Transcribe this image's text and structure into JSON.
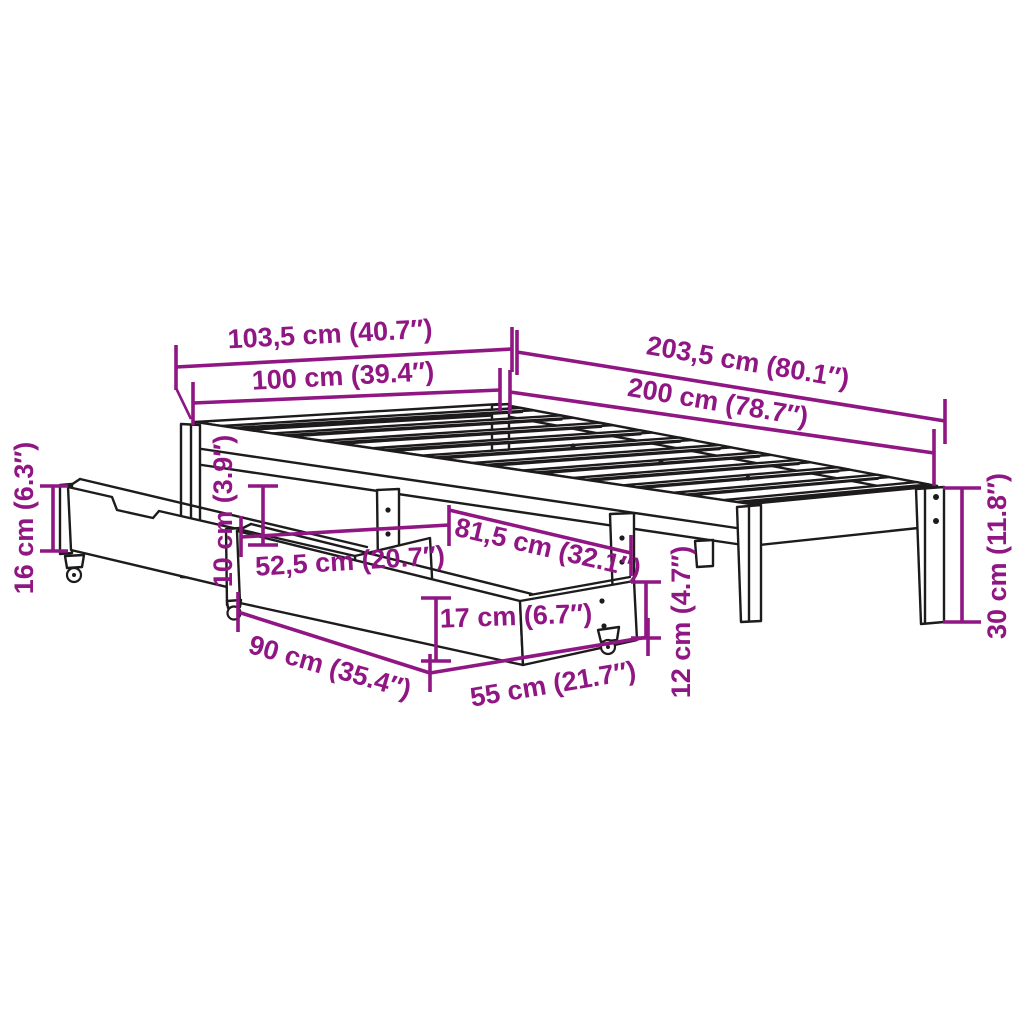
{
  "diagram": {
    "subject": "bed-frame-with-two-storage-drawers-dimension-drawing",
    "colors": {
      "dimension": "#8F1683",
      "outline": "#1d1b1b",
      "background": "#ffffff"
    },
    "dimensions": [
      {
        "id": "width-overall",
        "label": "103,5 cm (40.7″)"
      },
      {
        "id": "width-frame",
        "label": "100 cm (39.4″)"
      },
      {
        "id": "length-overall",
        "label": "203,5 cm (80.1″)"
      },
      {
        "id": "length-frame",
        "label": "200 cm (78.7″)"
      },
      {
        "id": "drawer-side-height",
        "label": "16 cm (6.3″)"
      },
      {
        "id": "clearance-height",
        "label": "10 cm (3.9″)"
      },
      {
        "id": "drawer-offset",
        "label": "52,5 cm (20.7″)"
      },
      {
        "id": "drawer-span",
        "label": "81,5 cm (32.1″)"
      },
      {
        "id": "drawer-front-height",
        "label": "17 cm (6.7″)"
      },
      {
        "id": "drawer-length",
        "label": "90 cm (35.4″)"
      },
      {
        "id": "drawer-width",
        "label": "55 cm (21.7″)"
      },
      {
        "id": "drawer-caster-height",
        "label": "12 cm (4.7″)"
      },
      {
        "id": "leg-height",
        "label": "30 cm (11.8″)"
      }
    ]
  }
}
